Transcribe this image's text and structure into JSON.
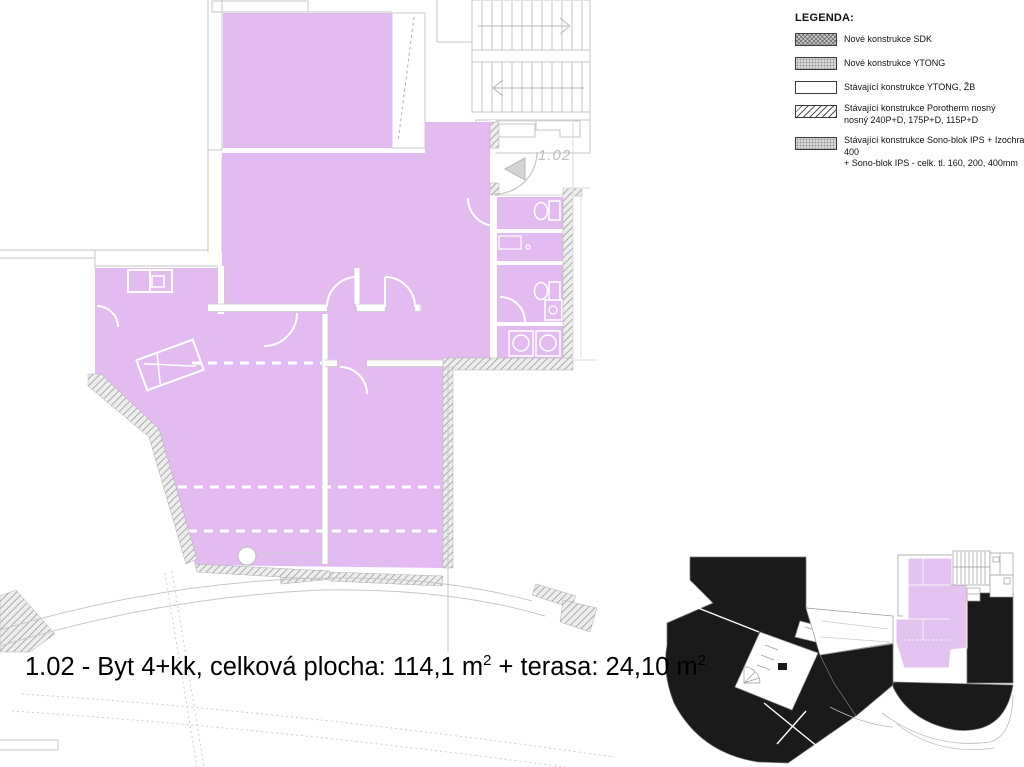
{
  "legend": {
    "title": "LEGENDA:",
    "items": [
      {
        "name": "sdk",
        "swatch": "crosshatch",
        "label": "Nové konstrukce SDK"
      },
      {
        "name": "ytong-new",
        "swatch": "stipple",
        "label": "Nové konstrukce YTONG"
      },
      {
        "name": "ytong-existing",
        "swatch": "plain",
        "label": "Stávající konstrukce YTONG, ŽB"
      },
      {
        "name": "porotherm",
        "swatch": "diagonal",
        "label": "Stávající konstrukce Porotherm nosný",
        "label2": "nosný 240P+D, 175P+D, 115P+D"
      },
      {
        "name": "sono-blok",
        "swatch": "stipple",
        "label": "Stávající konstrukce Sono-blok IPS + Izochran 400",
        "label2": "+ Sono-blok IPS - celk. tl. 160, 200, 400mm"
      }
    ]
  },
  "plan": {
    "unit_door_label": "1.02"
  },
  "caption": {
    "part1": "1.02 - Byt 4+kk, celková plocha: 114,1 m",
    "sup1": "2",
    "part2": " + terasa: 24,10 m",
    "sup2": "2"
  },
  "colors": {
    "apartment_fill": "#e3bbf1",
    "keyplan_highlight": "#e5c3f0",
    "keyplan_black": "#1a1a1a",
    "wall_line": "#c6c6c6",
    "caption_text": "#000000",
    "plan_label": "#bdbdbd"
  }
}
